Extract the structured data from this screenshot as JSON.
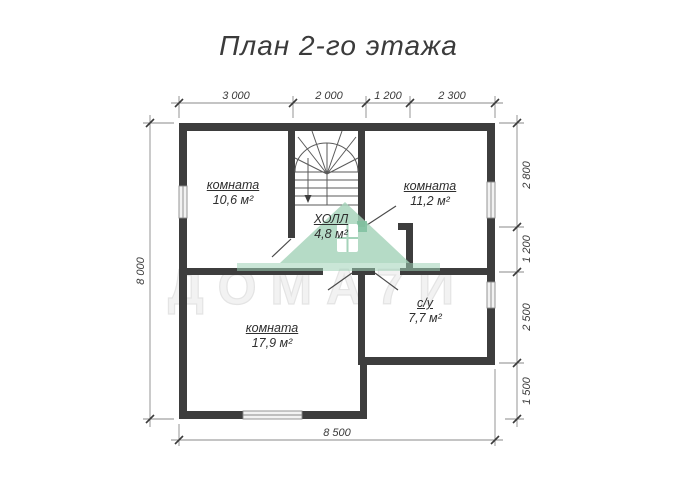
{
  "title": "План 2-го этажа",
  "dimensions": {
    "top": [
      "3 000",
      "2 000",
      "1 200",
      "2 300"
    ],
    "right": [
      "2 800",
      "1 200",
      "2 500",
      "1 500"
    ],
    "left": "8 000",
    "bottom": "8 500"
  },
  "rooms": [
    {
      "name": "комната",
      "area": "10,6 м²"
    },
    {
      "name": "комната",
      "area": "11,2 м²"
    },
    {
      "name": "ХОЛЛ",
      "area": "4,8 м²"
    },
    {
      "name": "комната",
      "area": "17,9 м²"
    },
    {
      "name": "с/у",
      "area": "7,7 м²"
    }
  ],
  "stairs": {
    "direction": "down-arrow"
  },
  "watermark": {
    "text": "ДОМА7И",
    "logo": "green-house",
    "accent_color": "#a5d3ba"
  },
  "colors": {
    "wall": "#3d3d3d",
    "thin_line": "#555555",
    "dim_line": "#8a8a8a",
    "text": "#3a3a3a"
  }
}
